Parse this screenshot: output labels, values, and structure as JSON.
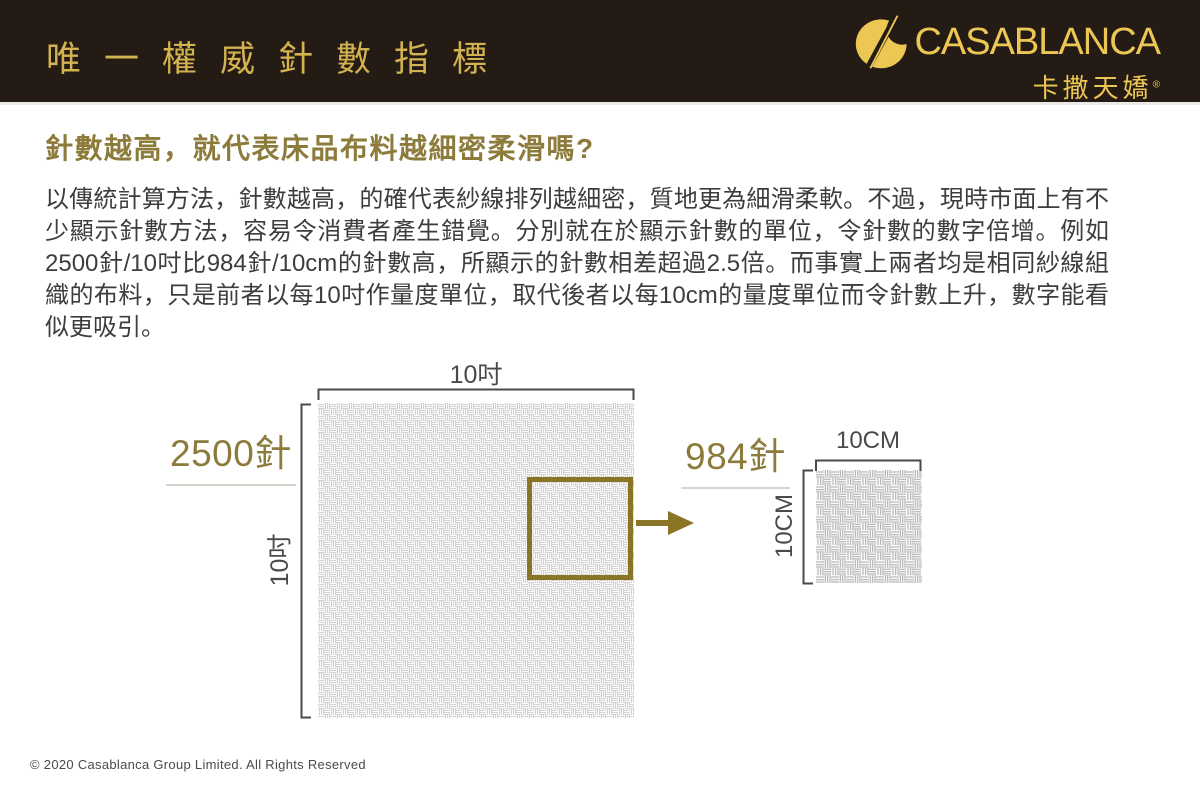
{
  "colors": {
    "header_bg": "#251b15",
    "header_title_gold": "#d3b250",
    "logo_gold": "#ecc753",
    "heading_olive": "#8c7b3b",
    "accent_gold": "#8a7426",
    "body_text": "#3d3d3d",
    "dimension_gray": "#4a4a4a"
  },
  "header": {
    "title": "唯一權威針數指標",
    "logo": {
      "brand": "CASABLANCA",
      "brand_cn": "卡撒天嬌",
      "registered_mark": "®",
      "icon": "casablanca-needle-c-icon"
    }
  },
  "content": {
    "heading": "針數越高，就代表床品布料越細密柔滑嗎?",
    "paragraph": "以傳統計算方法，針數越高，的確代表紗線排列越細密，質地更為細滑柔軟。不過，現時市面上有不少顯示針數方法，容易令消費者產生錯覺。分別就在於顯示針數的單位，令針數的數字倍增。例如2500針/10吋比984針/10cm的針數高，所顯示的針數相差超過2.5倍。而事實上兩者均是相同紗線組織的布料，只是前者以每10吋作量度單位，取代後者以每10cm的量度單位而令針數上升，數字能看似更吸引。"
  },
  "diagram": {
    "large_swatch": {
      "count_label": "2500針",
      "width_label": "10吋",
      "height_label": "10吋"
    },
    "small_swatch": {
      "count_label": "984針",
      "width_label": "10CM",
      "height_label": "10CM"
    }
  },
  "footer": {
    "copyright": "© 2020 Casablanca Group Limited. All Rights Reserved"
  }
}
